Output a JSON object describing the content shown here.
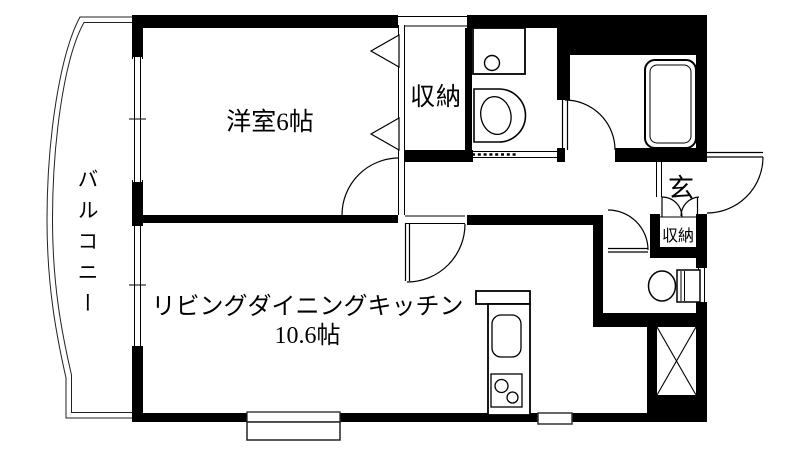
{
  "plan": {
    "kind": "apartment-floor-plan",
    "colors": {
      "wall": "#000000",
      "line": "#1a1a1a",
      "background": "#ffffff"
    },
    "rooms": {
      "western_room": {
        "label": "洋室6帖"
      },
      "closet": {
        "label": "収納"
      },
      "living_dining_kitchen": {
        "label_line1": "リビングダイニングキッチン",
        "label_line2": "10.6帖"
      },
      "balcony": {
        "label": "バルコニー"
      },
      "entrance": {
        "label": "玄"
      },
      "entrance_storage": {
        "label": "収納"
      }
    },
    "fixtures": [
      "bathtub",
      "toilet",
      "washbasin-vanity",
      "washing-machine-pan",
      "kitchen-sink",
      "two-burner-stove",
      "pipe-shaft"
    ]
  }
}
